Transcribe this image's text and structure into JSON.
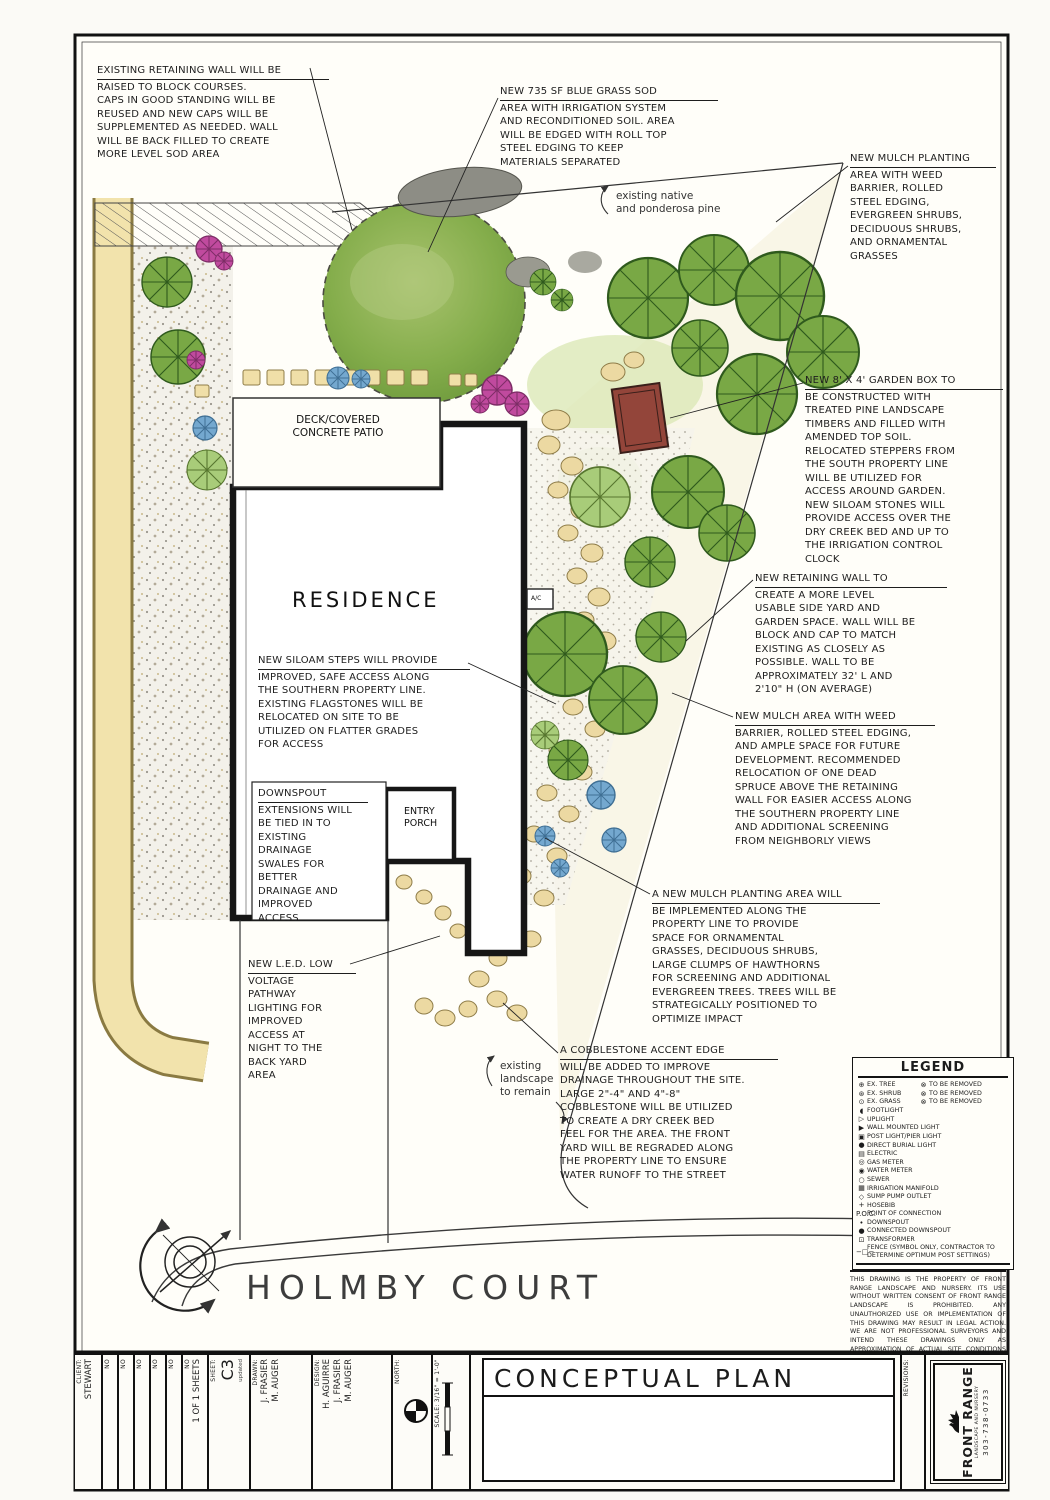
{
  "colors": {
    "ink": "#1c1c1c",
    "sod_green": "#7fae4e",
    "tree_green": "#6d9c3f",
    "path_tan": "#f2e3ac",
    "stone_tan": "#ecd9a2",
    "garden_box_red": "#93453a",
    "shrub_pink": "#c04a9e",
    "shrub_blue": "#74a8cf"
  },
  "plan_labels": {
    "residence": "RESIDENCE",
    "deck": "DECK/COVERED\nCONCRETE PATIO",
    "entry_porch": "ENTRY\nPORCH",
    "ac": "A/C",
    "street": "HOLMBY COURT"
  },
  "notes": {
    "native_pine": "existing native\nand ponderosa pine",
    "existing_landscape": "existing\nlandscape\nto remain"
  },
  "annotations": {
    "retaining_wall": {
      "title": "EXISTING RETAINING WALL WILL BE",
      "body": "RAISED TO BLOCK COURSES.\nCAPS IN GOOD STANDING WILL BE\nREUSED AND NEW CAPS WILL BE\nSUPPLEMENTED AS NEEDED. WALL\nWILL BE BACK FILLED TO CREATE\nMORE LEVEL SOD AREA"
    },
    "sod": {
      "title": "NEW 735 SF BLUE GRASS SOD",
      "body": "AREA WITH IRRIGATION SYSTEM\nAND RECONDITIONED SOIL. AREA\nWILL BE EDGED WITH ROLL TOP\nSTEEL EDGING TO KEEP\nMATERIALS SEPARATED"
    },
    "mulch_planting": {
      "title": "NEW MULCH PLANTING",
      "body": "AREA WITH WEED\nBARRIER, ROLLED\nSTEEL EDGING,\nEVERGREEN SHRUBS,\nDECIDUOUS SHRUBS,\nAND ORNAMENTAL\nGRASSES"
    },
    "garden_box": {
      "title": "NEW 8' X 4' GARDEN BOX TO",
      "body": "BE CONSTRUCTED WITH\nTREATED PINE LANDSCAPE\nTIMBERS AND FILLED WITH\nAMENDED TOP SOIL.\nRELOCATED STEPPERS FROM\nTHE SOUTH PROPERTY LINE\nWILL BE UTILIZED FOR\nACCESS AROUND GARDEN.\nNEW SILOAM STONES WILL\nPROVIDE ACCESS OVER THE\nDRY CREEK BED AND UP TO\nTHE IRRIGATION CONTROL\nCLOCK"
    },
    "new_retaining_wall": {
      "title": "NEW RETAINING WALL TO",
      "body": "CREATE A MORE LEVEL\nUSABLE SIDE YARD AND\nGARDEN SPACE. WALL WILL BE\nBLOCK AND CAP TO MATCH\nEXISTING AS CLOSELY AS\nPOSSIBLE. WALL TO BE\nAPPROXIMATELY 32' L AND\n2'10\" H (ON AVERAGE)"
    },
    "mulch_area": {
      "title": "NEW MULCH AREA WITH WEED",
      "body": "BARRIER, ROLLED STEEL EDGING,\nAND AMPLE SPACE FOR FUTURE\nDEVELOPMENT. RECOMMENDED\nRELOCATION OF ONE DEAD\nSPRUCE ABOVE THE RETAINING\nWALL FOR EASIER ACCESS ALONG\nTHE SOUTHERN PROPERTY LINE\nAND ADDITIONAL SCREENING\nFROM NEIGHBORLY VIEWS"
    },
    "mulch_planting_area": {
      "title": "A NEW MULCH PLANTING AREA WILL",
      "body": "BE IMPLEMENTED ALONG THE\nPROPERTY LINE TO PROVIDE\nSPACE FOR ORNAMENTAL\nGRASSES, DECIDUOUS SHRUBS,\nLARGE CLUMPS OF HAWTHORNS\nFOR SCREENING AND ADDITIONAL\nEVERGREEN TREES. TREES WILL BE\nSTRATEGICALLY POSITIONED TO\nOPTIMIZE IMPACT"
    },
    "cobblestone": {
      "title": "A COBBLESTONE ACCENT EDGE",
      "body": "WILL BE ADDED TO IMPROVE\nDRAINAGE THROUGHOUT THE SITE.\nLARGE 2\"-4\" AND 4\"-8\"\nCOBBLESTONE WILL BE UTILIZED\nTO CREATE A DRY CREEK BED\nFEEL FOR THE AREA. THE FRONT\nYARD WILL BE REGRADED ALONG\nTHE PROPERTY LINE TO ENSURE\nWATER RUNOFF TO THE STREET"
    },
    "siloam_steps": {
      "title": "NEW SILOAM STEPS WILL PROVIDE",
      "body": "IMPROVED, SAFE ACCESS ALONG\nTHE SOUTHERN PROPERTY LINE.\nEXISTING FLAGSTONES WILL BE\nRELOCATED ON SITE TO BE\nUTILIZED ON FLATTER GRADES\nFOR ACCESS"
    },
    "downspout": {
      "title": "DOWNSPOUT",
      "body": "EXTENSIONS WILL\nBE TIED IN TO\nEXISTING\nDRAINAGE\nSWALES FOR\nBETTER\nDRAINAGE AND\nIMPROVED\nACCESS"
    },
    "led_lighting": {
      "title": "NEW L.E.D. LOW",
      "body": "VOLTAGE\nPATHWAY\nLIGHTING FOR\nIMPROVED\nACCESS AT\nNIGHT TO THE\nBACK YARD\nAREA"
    }
  },
  "legend": {
    "title": "LEGEND",
    "pairs": [
      {
        "s1": "⊕",
        "l1": "EX. TREE",
        "s2": "⊗",
        "l2": "TO BE REMOVED"
      },
      {
        "s1": "⊛",
        "l1": "EX. SHRUB",
        "s2": "⊗",
        "l2": "TO BE REMOVED"
      },
      {
        "s1": "⊙",
        "l1": "EX. GRASS",
        "s2": "⊗",
        "l2": "TO BE REMOVED"
      }
    ],
    "items": [
      {
        "sym": "◖",
        "label": "FOOTLIGHT"
      },
      {
        "sym": "▷",
        "label": "UPLIGHT"
      },
      {
        "sym": "▶",
        "label": "WALL MOUNTED LIGHT"
      },
      {
        "sym": "▣",
        "label": "POST LIGHT/PIER LIGHT"
      },
      {
        "sym": "●",
        "label": "DIRECT BURIAL LIGHT"
      },
      {
        "sym": "▤",
        "label": "ELECTRIC"
      },
      {
        "sym": "◎",
        "label": "GAS METER"
      },
      {
        "sym": "◉",
        "label": "WATER METER"
      },
      {
        "sym": "○",
        "label": "SEWER"
      },
      {
        "sym": "▦",
        "label": "IRRIGATION MANIFOLD"
      },
      {
        "sym": "◇",
        "label": "SUMP PUMP OUTLET"
      },
      {
        "sym": "+",
        "label": "HOSEBIB"
      },
      {
        "sym": "P.O.C.",
        "label": "POINT OF CONNECTION"
      },
      {
        "sym": "•",
        "label": "DOWNSPOUT"
      },
      {
        "sym": "●",
        "label": "CONNECTED DOWNSPOUT"
      },
      {
        "sym": "⊡",
        "label": "TRANSFORMER"
      },
      {
        "sym": "−□−",
        "label": "FENCE (SYMBOL ONLY, CONTRACTOR TO DETERMINE OPTIMUM POST SETTINGS)"
      }
    ]
  },
  "disclaimer": "THIS DRAWING IS THE PROPERTY OF FRONT RANGE LANDSCAPE AND NURSERY. ITS USE WITHOUT WRITTEN CONSENT OF FRONT RANGE LANDSCAPE IS PROHIBITED. ANY UNAUTHORIZED USE OR IMPLEMENTATION OF THIS DRAWING MAY RESULT IN LEGAL ACTION. WE ARE NOT PROFESSIONAL SURVEYORS AND INTEND THESE DRAWINGS ONLY AS APPROXIMATION OF ACTUAL SITE CONDITIONS AND AS A GUIDE FOR NEW CONSTRUCTION.",
  "title_block": {
    "client_label": "CLIENT:",
    "client": "STEWART",
    "no_label": "NO",
    "sheets": "1 OF 1 SHEETS",
    "sheet_label": "SHEET:",
    "sheet": "C3",
    "sheet_note": "updated",
    "drawn_label": "DRAWN:",
    "drawn1": "J. FRASIER",
    "drawn2": "M. AUGER",
    "design_label": "DESIGN:",
    "design1": "H. AGUIRRE",
    "design2": "J. FRASIER",
    "design3": "M. AUGER",
    "north_label": "NORTH:",
    "scale_label": "SCALE: 3/16\" = 1'-0\"",
    "plan_title": "CONCEPTUAL PLAN",
    "revisions_label": "REVISIONS:",
    "logo_name": "FRONT RANGE",
    "logo_sub": "LANDSCAPE AND NURSERY",
    "logo_phone": "303-738-0733"
  }
}
